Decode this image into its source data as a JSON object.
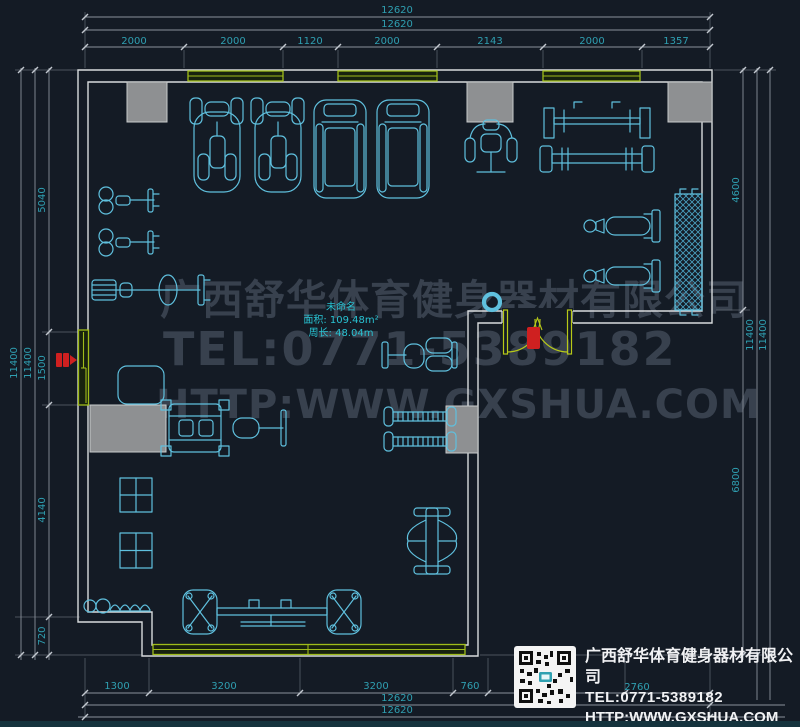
{
  "watermark": {
    "line1": "广西舒华体育健身器材有限公司",
    "line2": "TEL:0771-5389182",
    "line3": "HTTP:WWW.GXSHUA.COM"
  },
  "room": {
    "name": "未命名",
    "area": "面积: 109.48m²",
    "perimeter": "周长: 48.04m"
  },
  "dims": {
    "top_total_1": "12620",
    "top_total_2": "12620",
    "top_segments": [
      "2000",
      "2000",
      "1120",
      "2000",
      "2143",
      "2000",
      "1357"
    ],
    "left_total_1": "11400",
    "left_total_2": "11400",
    "left_segments": [
      "5040",
      "1500",
      "4140",
      "720"
    ],
    "right_segments": [
      "4600",
      "6800"
    ],
    "right_total_1": "11400",
    "right_total_2": "11400",
    "bottom_segments": [
      "1300",
      "3200",
      "3200",
      "760",
      "2760"
    ],
    "bottom_total_1": "12620",
    "bottom_total_2": "12620"
  },
  "title_block": {
    "company": "广西舒华体育健身器材有限公司",
    "tel": "TEL:0771-5389182",
    "url": "HTTP:WWW.GXSHUA.COM"
  },
  "colors": {
    "background": "#141b25",
    "dimension_text": "#2f9fb1",
    "dimension_line": "#8a919b",
    "wall": "#d8dbdd",
    "window_green": "#9fbc1a",
    "equipment_cyan": "#5fc0de",
    "column_gray": "#8e9092",
    "alarm_red": "#cf2020",
    "watermark_gray": "#38414e",
    "title_text": "#f1f2f4",
    "footer_strip": "#15333d"
  }
}
